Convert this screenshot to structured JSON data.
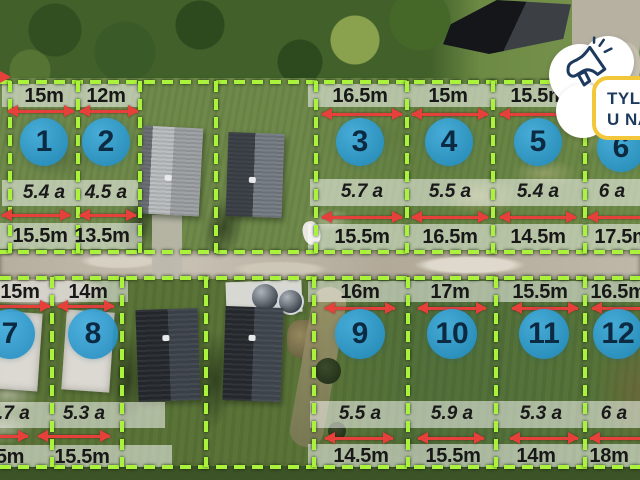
{
  "badge": {
    "line1": "TYLKO",
    "line2": "U NAS",
    "icon": "megaphone-icon",
    "accent_color": "#f2c83a",
    "text_color": "#1c3a5e"
  },
  "colors": {
    "plot_boundary": "#abf23c",
    "dimension_arrow": "#e5403a",
    "number_circle_fill": "#2792c6",
    "number_circle_text": "#0c2a42",
    "label_text": "#181818",
    "label_band": "rgba(255,255,255,0.52)"
  },
  "rows": {
    "top": {
      "plots": [
        {
          "number": "1",
          "top_dim": "15m",
          "area": "5.4 a",
          "bottom_dim": "15.5m"
        },
        {
          "number": "2",
          "top_dim": "12m",
          "area": "4.5 a",
          "bottom_dim": "13.5m"
        },
        {
          "number": "3",
          "top_dim": "16.5m",
          "area": "5.7 a",
          "bottom_dim": "15.5m"
        },
        {
          "number": "4",
          "top_dim": "15m",
          "area": "5.5 a",
          "bottom_dim": "16.5m"
        },
        {
          "number": "5",
          "top_dim": "15.5m",
          "area": "5.4 a",
          "bottom_dim": "14.5m"
        },
        {
          "number": "6",
          "top_dim": "",
          "area": "6 a",
          "bottom_dim": "17.5m"
        }
      ]
    },
    "bottom": {
      "plots": [
        {
          "number": "7",
          "top_dim": "15m",
          "area": ".7 a",
          "bottom_dim": "5m"
        },
        {
          "number": "8",
          "top_dim": "14m",
          "area": "5.3 a",
          "bottom_dim": "15.5m"
        },
        {
          "number": "9",
          "top_dim": "16m",
          "area": "5.5 a",
          "bottom_dim": "14.5m"
        },
        {
          "number": "10",
          "top_dim": "17m",
          "area": "5.9 a",
          "bottom_dim": "15.5m"
        },
        {
          "number": "11",
          "top_dim": "15.5m",
          "area": "5.3 a",
          "bottom_dim": "14m"
        },
        {
          "number": "12",
          "top_dim": "16.5m",
          "area": "6 a",
          "bottom_dim": "18m"
        }
      ]
    }
  }
}
